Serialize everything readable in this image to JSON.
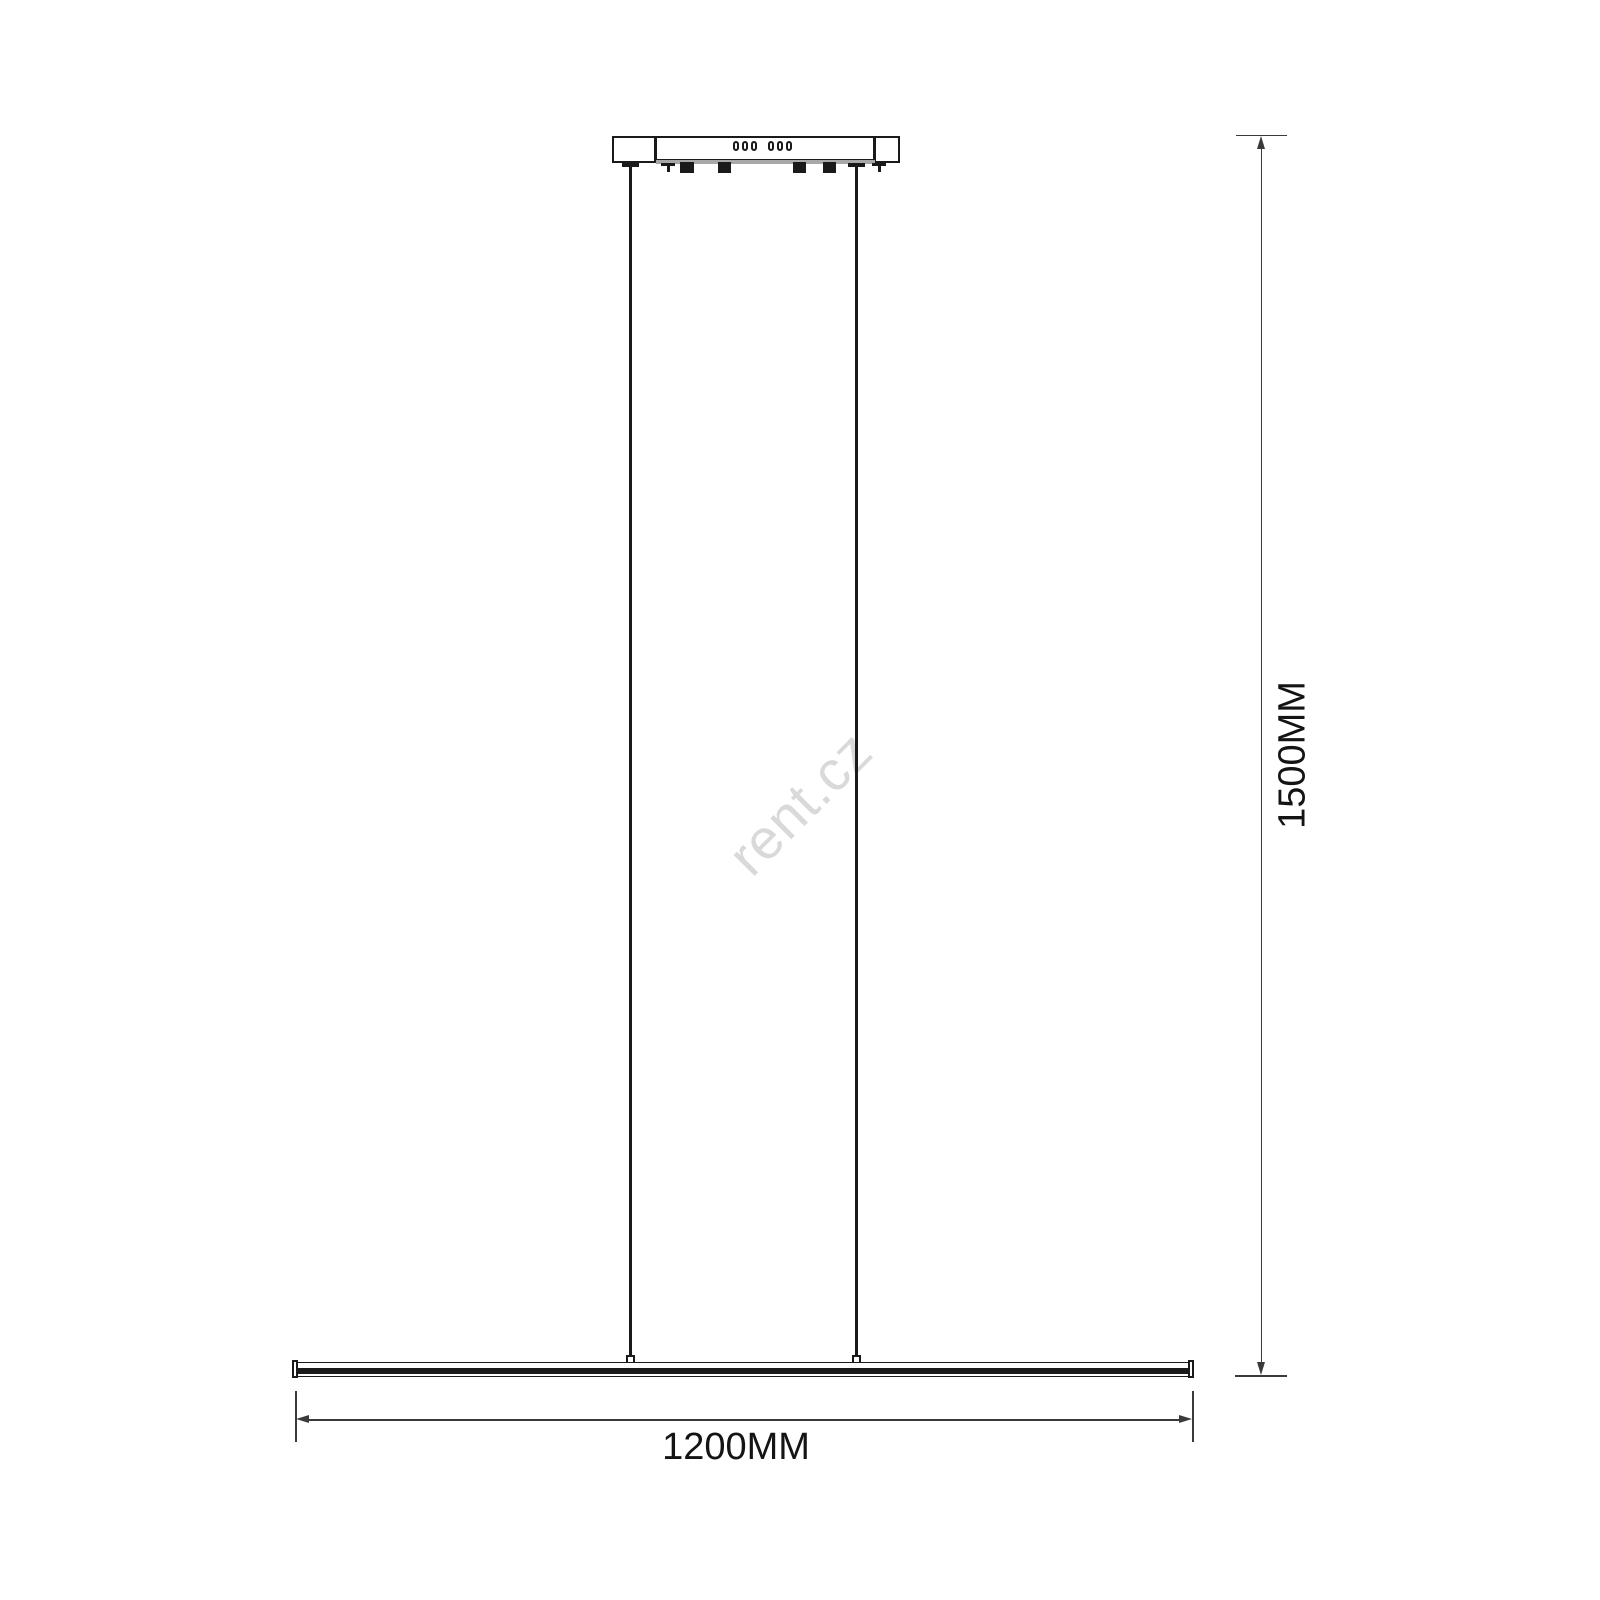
{
  "diagram": {
    "type": "technical-dimension-drawing",
    "subject": "linear pendant light fixture, front elevation",
    "watermark_text": "rent.cz",
    "dimensions": {
      "width_label": "1200MM",
      "width_value_mm": 1200,
      "height_label": "1500MM",
      "height_value_mm": 1500
    },
    "parts": {
      "canopy": "ceiling mounting canopy with 6 vent slots, 4 mounting clips and 2 screws",
      "suspension": "2 suspension wires",
      "bar": "linear LED light bar"
    },
    "colors": {
      "line": "#1a1a1a",
      "dim_line": "#3a3a3a",
      "canopy_strip": "#a8a8a8",
      "watermark": "#d9d9d9",
      "background": "#ffffff",
      "text": "#141414"
    }
  }
}
